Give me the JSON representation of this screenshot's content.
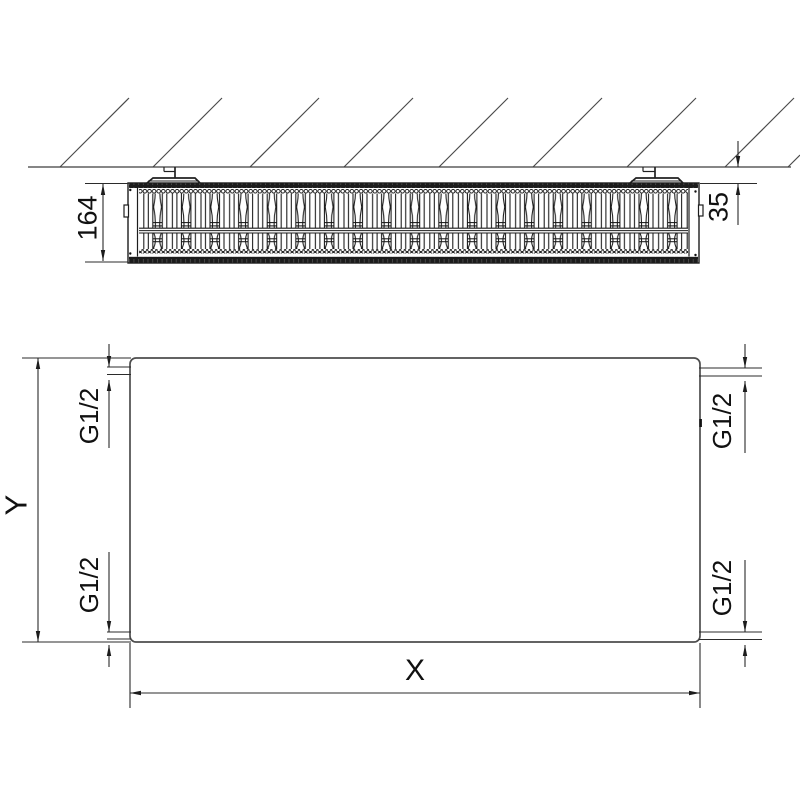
{
  "top_view": {
    "depth_dimension": "164",
    "wall_clearance_dimension": "35"
  },
  "front_view": {
    "height_dimension": "Y",
    "width_dimension": "X",
    "connections": {
      "top_left": "G1/2",
      "top_right": "G1/2",
      "bottom_left": "G1/2",
      "bottom_right": "G1/2"
    }
  },
  "colors": {
    "line": "#2b2b2b",
    "background": "#ffffff"
  }
}
